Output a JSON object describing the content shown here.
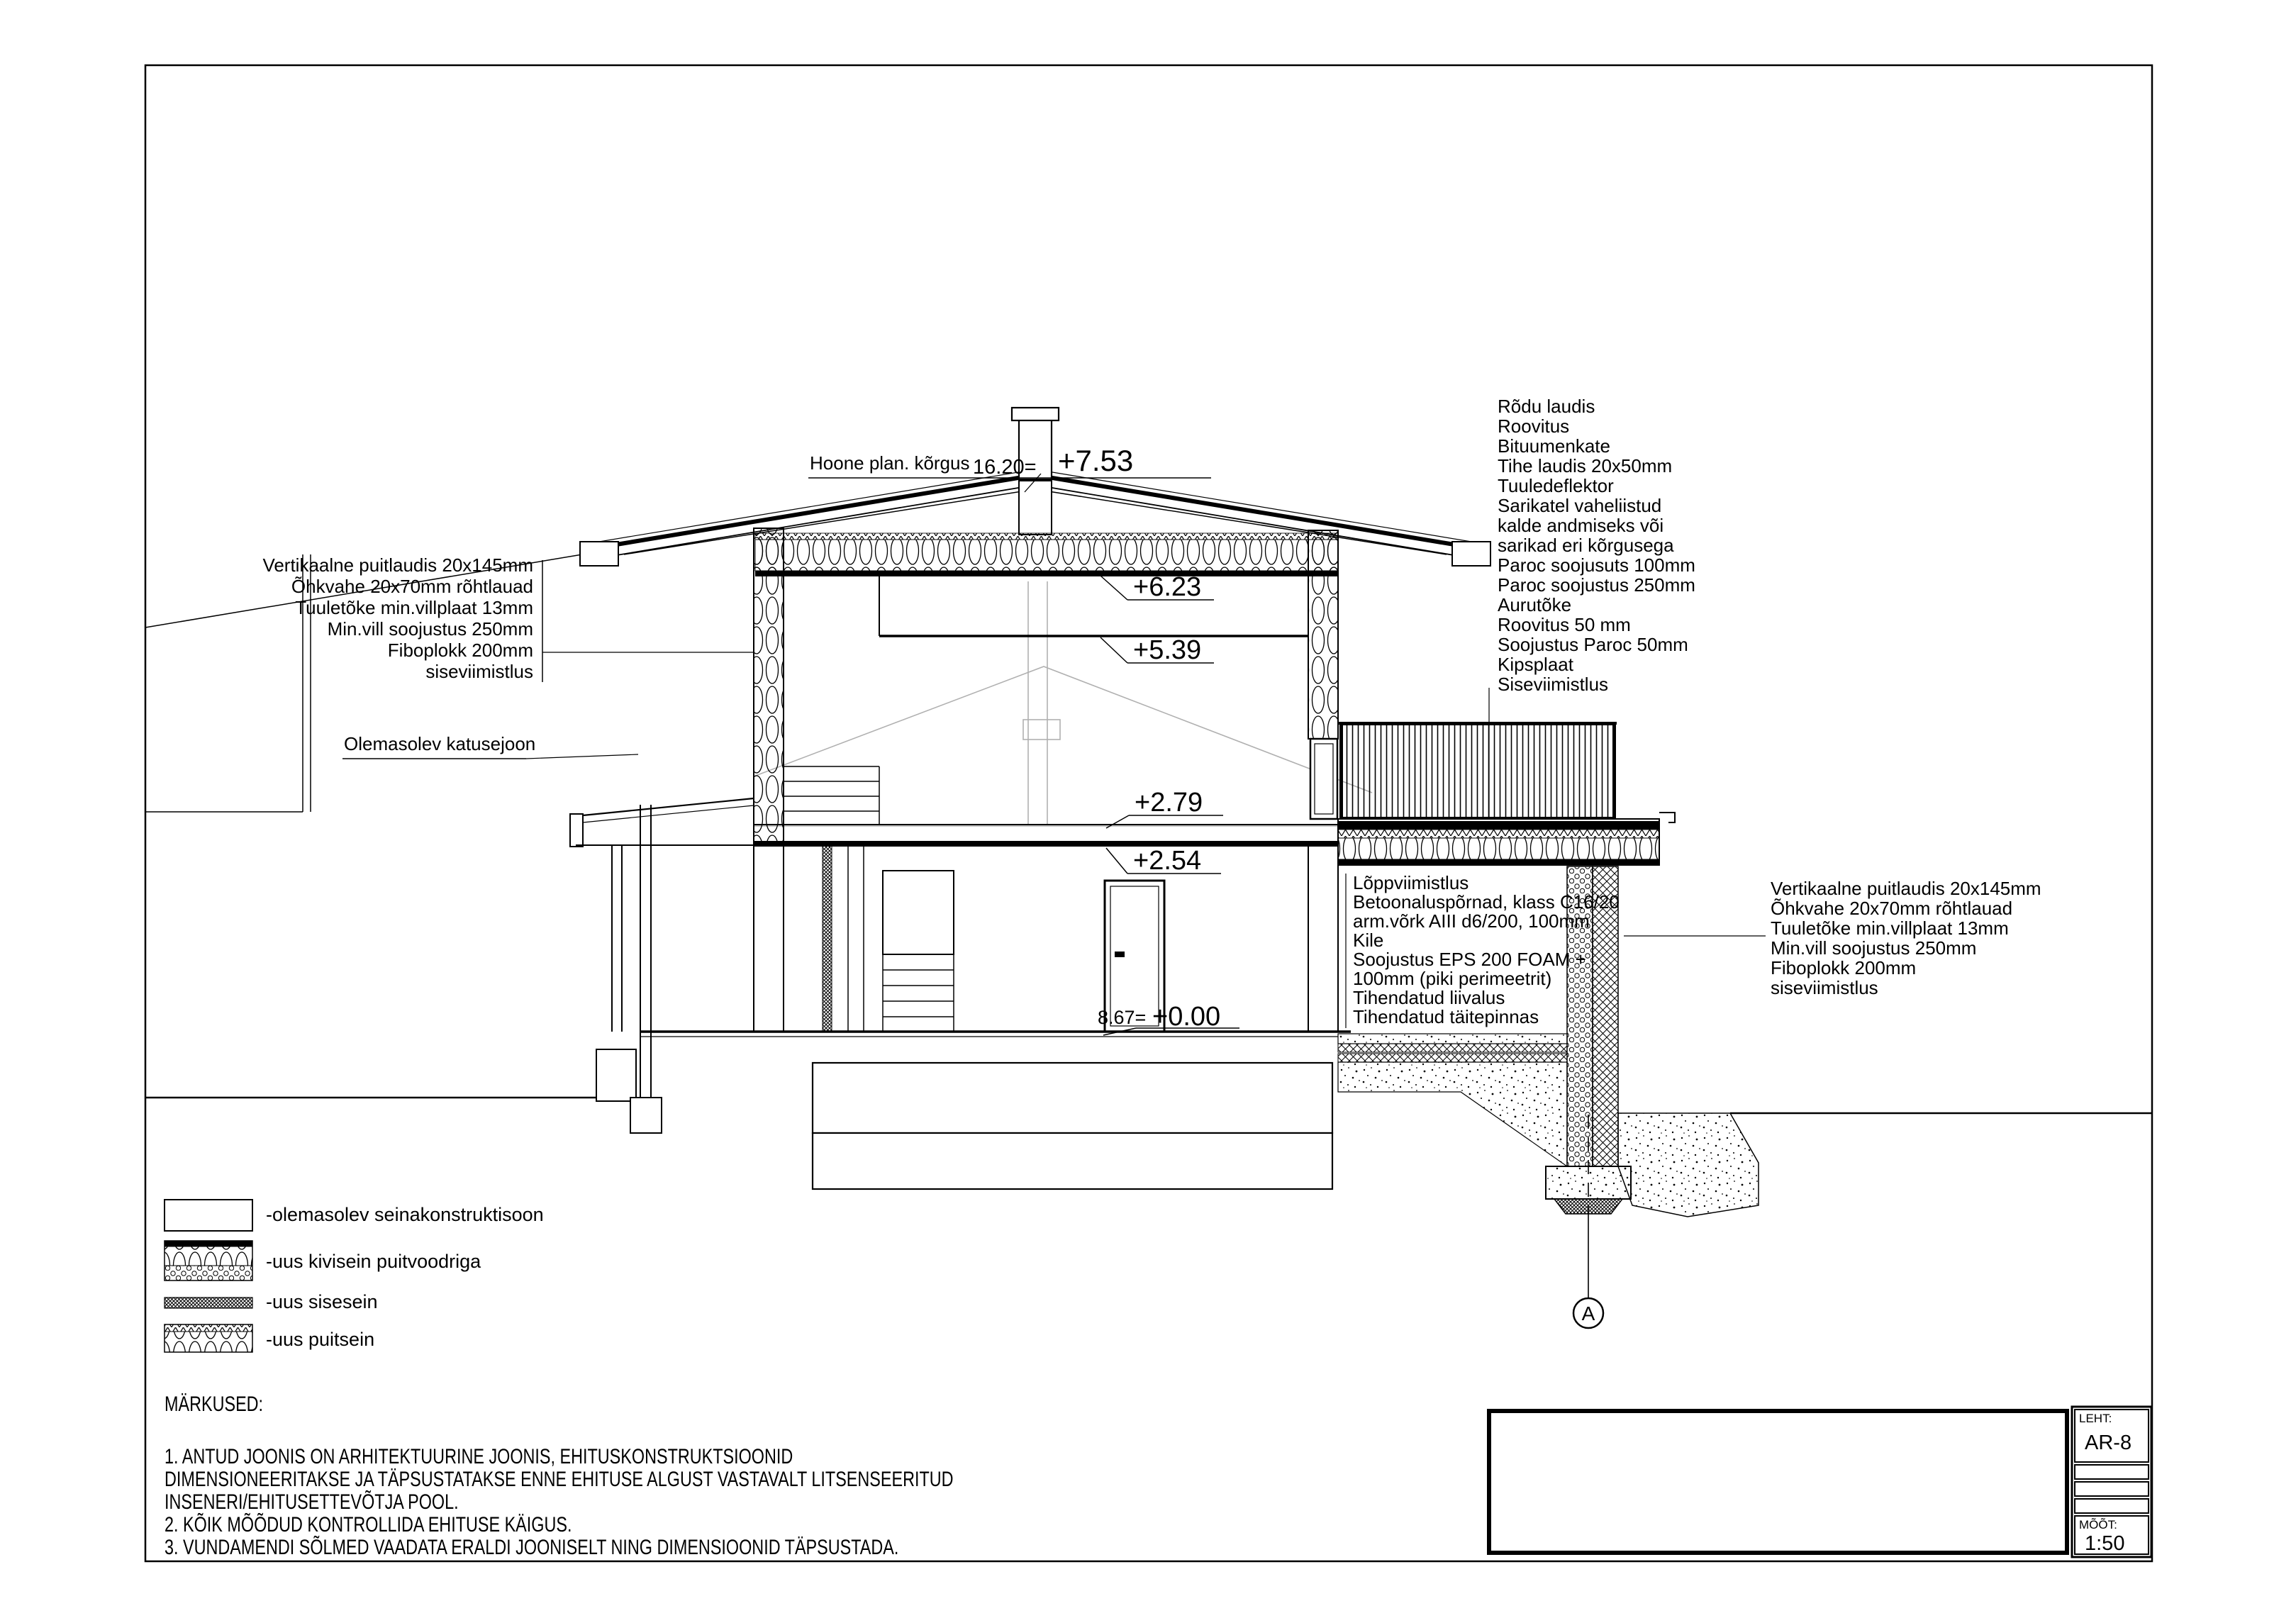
{
  "drawing": {
    "title_annotation": {
      "label": "Hoone plan. kõrgus",
      "abs_height": "16.20=",
      "ridge_level": "+7.53"
    },
    "level_markers": {
      "ceiling_2f": "+6.23",
      "suspended_ceiling": "+5.39",
      "floor_2f": "+2.79",
      "ceiling_1f": "+2.54",
      "floor_abs": "8.67=",
      "floor_0": "+0.00"
    },
    "labels": {
      "existing_roofline": "Olemasolev katusejoon",
      "wall_left": {
        "lines": [
          "Vertikaalne puitlaudis 20x145mm",
          "Õhkvahe 20x70mm rõhtlauad",
          "Tuuletõke min.villplaat 13mm",
          "Min.vill soojustus 250mm",
          "Fiboplokk 200mm",
          "siseviimistlus"
        ]
      },
      "roof_balcony_right": {
        "lines": [
          "Rõdu laudis",
          "Roovitus",
          "Bituumenkate",
          "Tihe laudis 20x50mm",
          "Tuuledeflektor",
          "Sarikatel vaheliistud",
          "kalde andmiseks või",
          "sarikad eri kõrgusega",
          "Paroc soojusuts 100mm",
          "Paroc soojustus 250mm",
          "Aurutõke",
          "Roovitus 50 mm",
          "Soojustus Paroc 50mm",
          "Kipsplaat",
          "Siseviimistlus"
        ]
      },
      "floor_slab": {
        "lines": [
          "Lõppviimistlus",
          "Betoonaluspõrnad, klass C16/20",
          "arm.võrk AIII d6/200, 100mm",
          "Kile",
          "Soojustus EPS 200 FOAM +",
          "100mm (piki perimeetrit)",
          "Tihendatud liivalus",
          "Tihendatud täitepinnas"
        ]
      },
      "wall_right": {
        "lines": [
          "Vertikaalne puitlaudis 20x145mm",
          "Õhkvahe 20x70mm rõhtlauad",
          "Tuuletõke min.villplaat 13mm",
          "Min.vill soojustus 250mm",
          "Fiboplokk 200mm",
          "siseviimistlus"
        ]
      }
    },
    "section_mark": "A",
    "legend": {
      "items": [
        {
          "label": "-olemasolev seinakonstruktisoon",
          "swatch": "existing-wall"
        },
        {
          "label": "-uus kivisein puitvoodriga",
          "swatch": "new-masonry-wood-clad"
        },
        {
          "label": "-uus sisesein",
          "swatch": "new-interior-wall"
        },
        {
          "label": "-uus puitsein",
          "swatch": "new-timber-wall"
        }
      ]
    },
    "notes": {
      "heading": "MÄRKUSED:",
      "lines": [
        "1. ANTUD JOONIS ON ARHITEKTUURINE JOONIS, EHITUSKONSTRUKTSIOONID",
        "DIMENSIONEERITAKSE JA TÄPSUSTATAKSE ENNE EHITUSE ALGUST VASTAVALT LITSENSEERITUD",
        "INSENERI/EHITUSETTEVÕTJA POOL.",
        "2. KÕIK MÕÕDUD KONTROLLIDA EHITUSE KÄIGUS.",
        "3. VUNDAMENDI SÕLMED VAADATA ERALDI JOONISELT NING DIMENSIOONID TÄPSUSTADA."
      ]
    },
    "title_block": {
      "sheet_label": "LEHT:",
      "sheet": "AR-8",
      "scale_label": "MÕÕT:",
      "scale": "1:50"
    },
    "colors": {
      "line": "#000000",
      "existing_gray": "#b0b0b0",
      "paper": "#ffffff"
    }
  }
}
